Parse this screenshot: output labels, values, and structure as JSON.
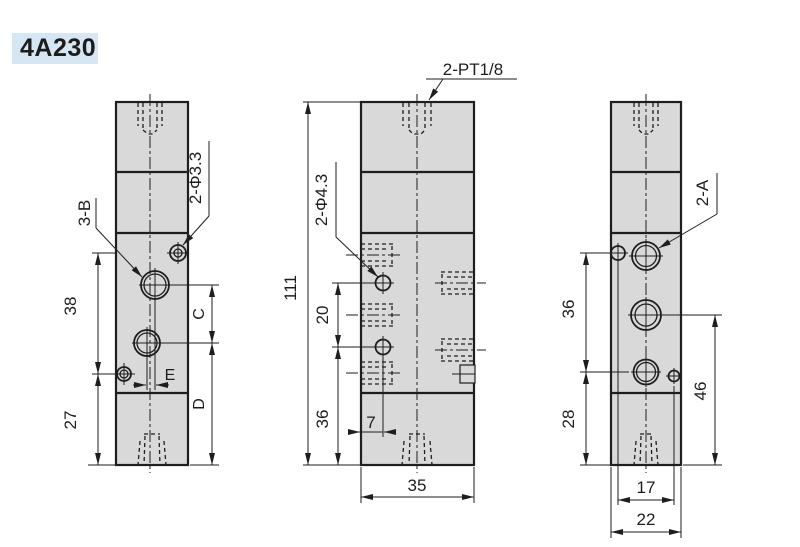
{
  "page": {
    "title": "4A230"
  },
  "colors": {
    "background": "#ffffff",
    "line": "#1e1e1e",
    "body_fill": "#d9d9d9",
    "title_bg": "#d6e6f3",
    "title_text": "#1c1c1c"
  },
  "views": {
    "left_side": {
      "labels": {
        "ports_label": "3-B",
        "holes_label": "2-Φ3.3",
        "dim_38": "38",
        "dim_27": "27",
        "dim_c": "C",
        "dim_d": "D",
        "dim_e": "E"
      }
    },
    "front": {
      "labels": {
        "top_ports_label": "2-PT1/8",
        "holes_label": "2-Φ4.3",
        "dim_111": "111",
        "dim_20": "20",
        "dim_36": "36",
        "dim_7": "7",
        "dim_35": "35"
      }
    },
    "right_side": {
      "labels": {
        "ports_label": "2-A",
        "dim_36": "36",
        "dim_28": "28",
        "dim_46": "46",
        "dim_17": "17",
        "dim_22": "22"
      }
    }
  }
}
